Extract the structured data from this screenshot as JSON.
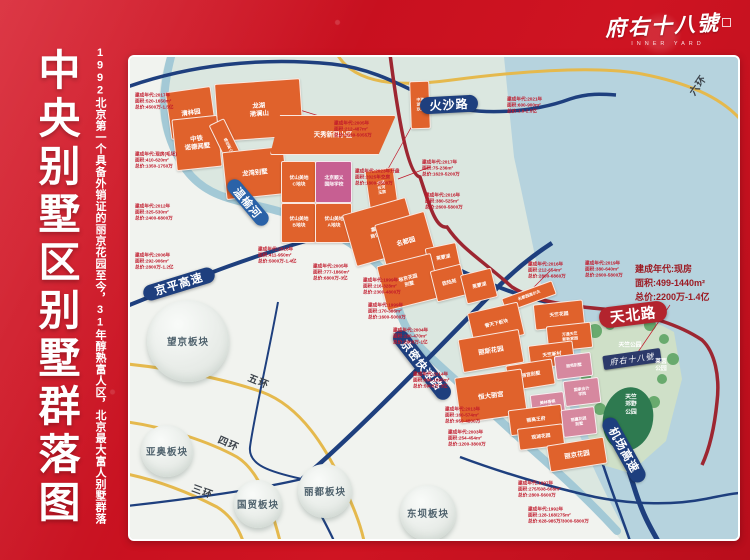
{
  "colors": {
    "frame_red": "#c8101f",
    "block_orange": "#e0622c",
    "block_pink": "#c75f92",
    "road_navy": "#1e3f7e",
    "road_dark_red": "#9d2631",
    "ring_yellow": "#e5b94d",
    "water": "#b6d3de",
    "park_green": "#cfe0c8",
    "info_red": "#c0182a"
  },
  "poster": {
    "title": "中央别墅区别墅群落图",
    "subtitle": "1992北京第一个具备外销证的丽京花园至今，31年醇熟富人区，北京最大富人别墅群落",
    "logo": "府右十八號",
    "logo_sub": "INNER YARD"
  },
  "highlight": {
    "text": "建成年代:现房\n面积:499-1440m²\n总价:2200万-1.4亿"
  },
  "project_tag": {
    "label": "府右十八號"
  },
  "roads": {
    "huosha": "火沙路",
    "wenyuhe": "温榆河",
    "jingping": "京平高速",
    "jingmi": "京密快速路",
    "tianbei": "天北路",
    "jichang": "机场高速",
    "ring6": "六环",
    "ring5": "五环",
    "ring4": "四环",
    "ring3": "三环"
  },
  "districts": [
    {
      "label": "望京板块"
    },
    {
      "label": "亚奥板块"
    },
    {
      "label": "国贸板块"
    },
    {
      "label": "丽都板块"
    },
    {
      "label": "东坝板块"
    }
  ],
  "parks": {
    "tianzhu": "天竺公园",
    "laiyin": "莱茵\n公园",
    "jiaoye": "天竺\n郊野\n公园"
  },
  "blocks": [
    {
      "name": "清林园"
    },
    {
      "name": "龙湖\n滟澜山"
    },
    {
      "name": "中铁\n诺德阅墅"
    },
    {
      "name": "格拉斯小镇"
    },
    {
      "name": "龙湾别墅"
    },
    {
      "name": "天秀新园小区"
    },
    {
      "name": "中海\n湖光\n玖里"
    },
    {
      "name": "优山美地\nC地块"
    },
    {
      "name": "北京顺义\n国际学校"
    },
    {
      "name": "优山美地\nB地块"
    },
    {
      "name": "优山美地\nA地块"
    },
    {
      "name": "龙湖\n云河\n玉宸"
    },
    {
      "name": "嘉浩国际\n商住别墅区"
    },
    {
      "name": "名都园"
    },
    {
      "name": "莱蒙湖"
    },
    {
      "name": "裕京花园\n别墅"
    },
    {
      "name": "欧陆苑"
    },
    {
      "name": "莱蒙湖"
    },
    {
      "name": "名都园高尔夫"
    },
    {
      "name": "誉天下板块"
    },
    {
      "name": "天竺花园"
    },
    {
      "name": "万通天竺\n新新家园"
    },
    {
      "name": "丽斯花园"
    },
    {
      "name": "天竺新村"
    },
    {
      "name": "丽苑别墅"
    },
    {
      "name": "丽宫别墅"
    },
    {
      "name": "国家会计\n学院"
    },
    {
      "name": "恒大丽宫"
    },
    {
      "name": "美林香槟\n小镇"
    },
    {
      "name": "丽高王府"
    },
    {
      "name": "丽嘉花园\n别墅"
    },
    {
      "name": "观湖花园"
    },
    {
      "name": "丽京花园"
    }
  ],
  "labels": [
    {
      "text": "建成年代:2017年\n面积:520-1650m²\n总价:4500万-1.5亿"
    },
    {
      "text": "建成年代:2005年\n面积:212-487m²\n总价:2030-5055万"
    },
    {
      "text": "建成年代:现房(毛坯)\n面积:410-620m²\n总价:1350-1750万"
    },
    {
      "text": "建成年代:2012年\n面积:325-530m²\n总价:2400-6800万"
    },
    {
      "text": "建成年代:2006年\n面积:292-906m²\n总价:2800万-1.2亿"
    },
    {
      "text": "建成年代:2023年开盘\n面积:2025年交房\n总价:1800-3500万"
    },
    {
      "text": "建成年代:2017年\n面积:75-236m²\n总价:1620-5200万"
    },
    {
      "text": "建成年代:2016年\n面积:380-525m²\n总价:2600-5800万"
    },
    {
      "text": "建成年代:2016年\n面积:411-950m²\n总价:5000万-1.4亿"
    },
    {
      "text": "建成年代:2005年\n面积:777-1860m²\n总价:6800万-3亿"
    },
    {
      "text": "建成年代:1999年\n面积:216-328m²\n总价:2300-4800万"
    },
    {
      "text": "建成年代:1999年\n面积:170-386m²\n总价:1600-5000万"
    },
    {
      "text": "建成年代:2004年\n面积:280-470m²\n总价:2800万-1亿"
    },
    {
      "text": "建成年代:2014年\n面积:686-1095m²\n总价:5900万-3亿"
    },
    {
      "text": "建成年代:2021年\n面积:600-900m²\n总价:1.9-2.5亿"
    },
    {
      "text": "建成年代:2016年\n面积:212-654m²\n总价:2800-6860万"
    },
    {
      "text": "建成年代:2019年\n面积:380-640m²\n总价:2600-5800万"
    },
    {
      "text": "建成年代:2013年\n面积:160-574m²\n总价:950-4800万"
    },
    {
      "text": "建成年代:2003年\n面积:254-454m²\n总价:1200-3800万"
    },
    {
      "text": "建成年代:1997年\n面积:275/508-608m²\n总价:2800-5600万"
    },
    {
      "text": "建成年代:1992年\n面积:128-168/275m²\n总价:628-985万/3000-5800万"
    }
  ]
}
